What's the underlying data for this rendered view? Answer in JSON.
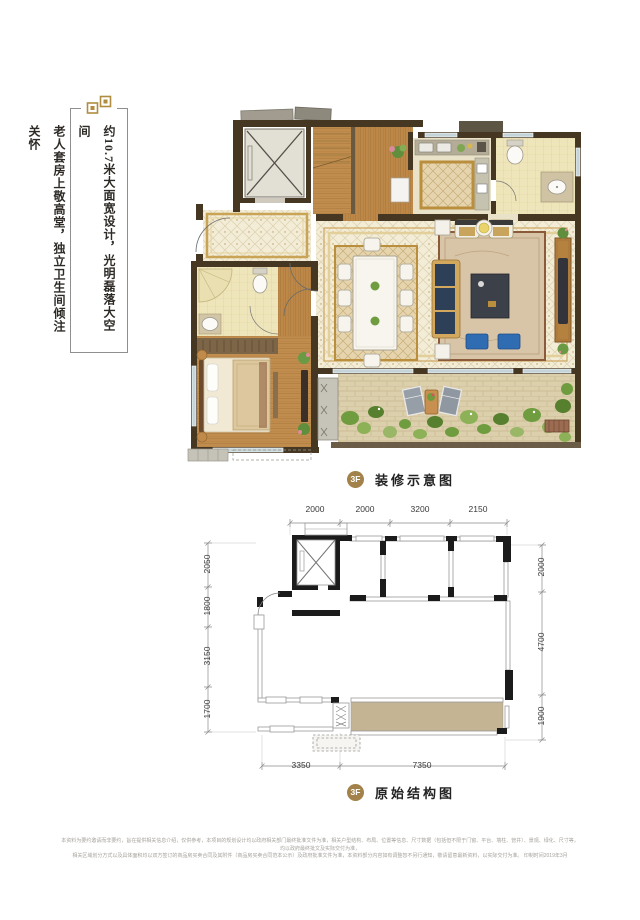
{
  "side_note": {
    "ornament_icon": "double-square-ornament",
    "column1": "约10.7米大面宽设计，光明磊落大空间",
    "column2": "老人套房上敬高堂，独立卫生间倾注关怀"
  },
  "decorated_plan": {
    "badge": "3F",
    "label": "装修示意图"
  },
  "structural_plan": {
    "badge": "3F",
    "label": "原始结构图",
    "dims_top": [
      "2000",
      "2000",
      "3200",
      "2150"
    ],
    "dims_left": [
      "2050",
      "1800",
      "3150",
      "1700"
    ],
    "dims_right": [
      "2000",
      "4700",
      "1900"
    ],
    "dims_bottom": [
      "3350",
      "7350"
    ]
  },
  "footer": {
    "line1": "本资料为要约邀请而非要约，旨在提供相关信息介绍，仅供参考，本项目的规划设计均以政府相关部门最终批准文件为准，相关户型结构、布局、位置等信息、尺寸数据（包括但不限于门窗、平台、墙柱、管井）、景观、绿化、尺寸等，均以政府最终批文及实际交付为准，",
    "line2": "相关区域划分方式以及具体面积均以双方签订的商品房买卖合同及其附件（商品房买卖合同范本公示）及政府批准文件为准，本资料部分内容如有调整恕不另行通知，敬请留意最新资料，以实际交付为准。  印制时间2019年3月"
  },
  "colors": {
    "accent_gold": "#a2824a",
    "ornament_gold": "#b08d3e",
    "wall_brown": "#463723",
    "wood": "#c18d4e",
    "tile_cream": "#f3ecd7",
    "rug_tan": "#d8c5a8",
    "sofa_navy": "#2e3f58",
    "ottoman_blue": "#2f6cb2",
    "greenery": "#6f9c3f",
    "terrace_stone": "#dccfac",
    "structural_wall": "#1b1b1b",
    "structural_terrace": "#c5b493"
  }
}
